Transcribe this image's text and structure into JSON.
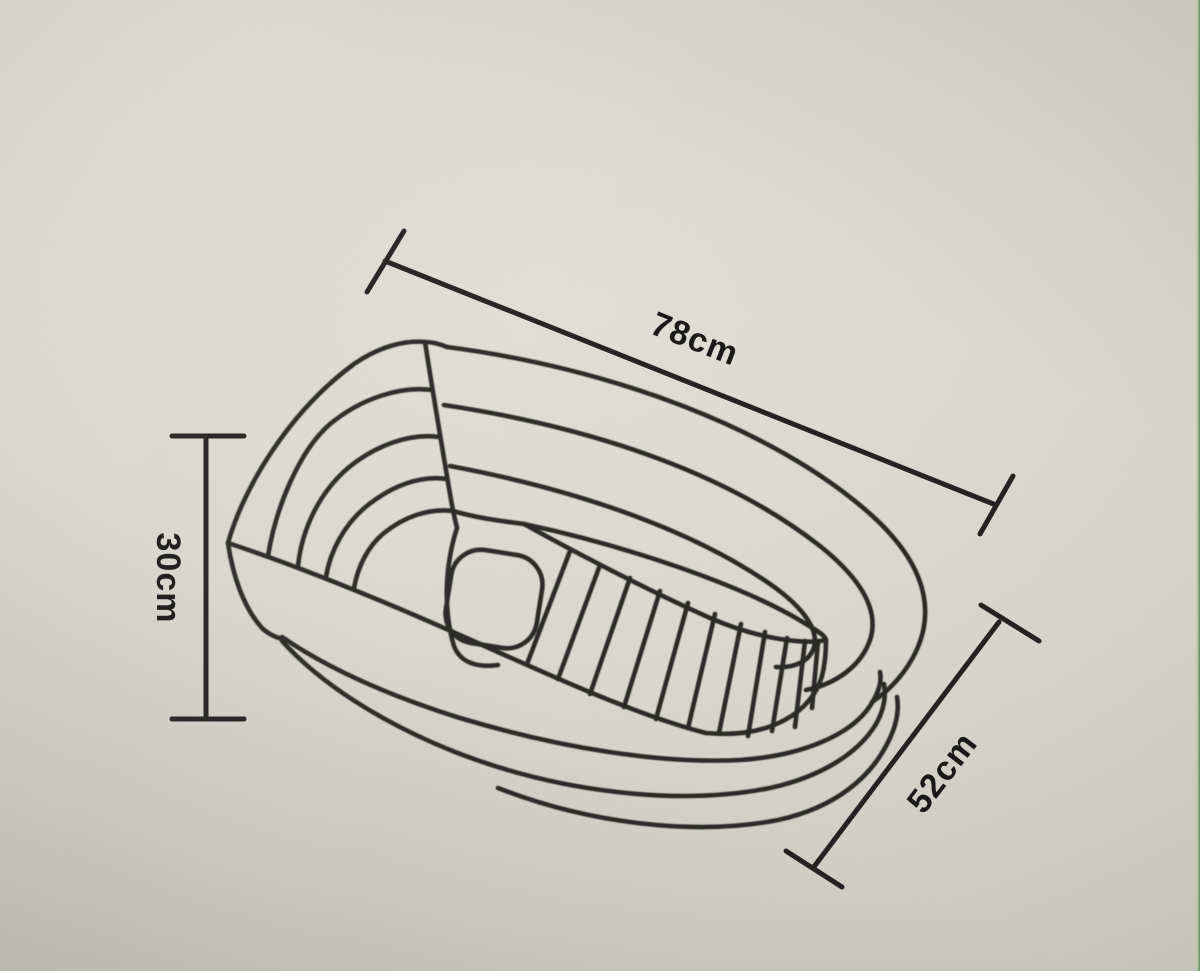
{
  "diagram": {
    "subject": "inflatable-bathtub-technical-line-drawing",
    "view": "three-quarter perspective sketch of an oval inflatable tub with ribbed floor, seat pad, rim seam and base ring",
    "labels": {
      "length": "78cm",
      "height": "30cm",
      "width": "52cm"
    },
    "dimensions": [
      {
        "id": "length",
        "value": "78cm",
        "placement": "upper-right diagonal",
        "text_rotation_deg": 21.5
      },
      {
        "id": "height",
        "value": "30cm",
        "placement": "left vertical",
        "text_rotation_deg": 90
      },
      {
        "id": "width",
        "value": "52cm",
        "placement": "lower-right diagonal",
        "text_rotation_deg": -52.5
      }
    ],
    "style": {
      "paper_color": "#dcd9d0",
      "ink_color": "#2a2926",
      "label_color": "#191917",
      "photo_edge_strip_light_green": "#b9cfae",
      "photo_edge_strip_dark_green": "#5d8457"
    }
  }
}
